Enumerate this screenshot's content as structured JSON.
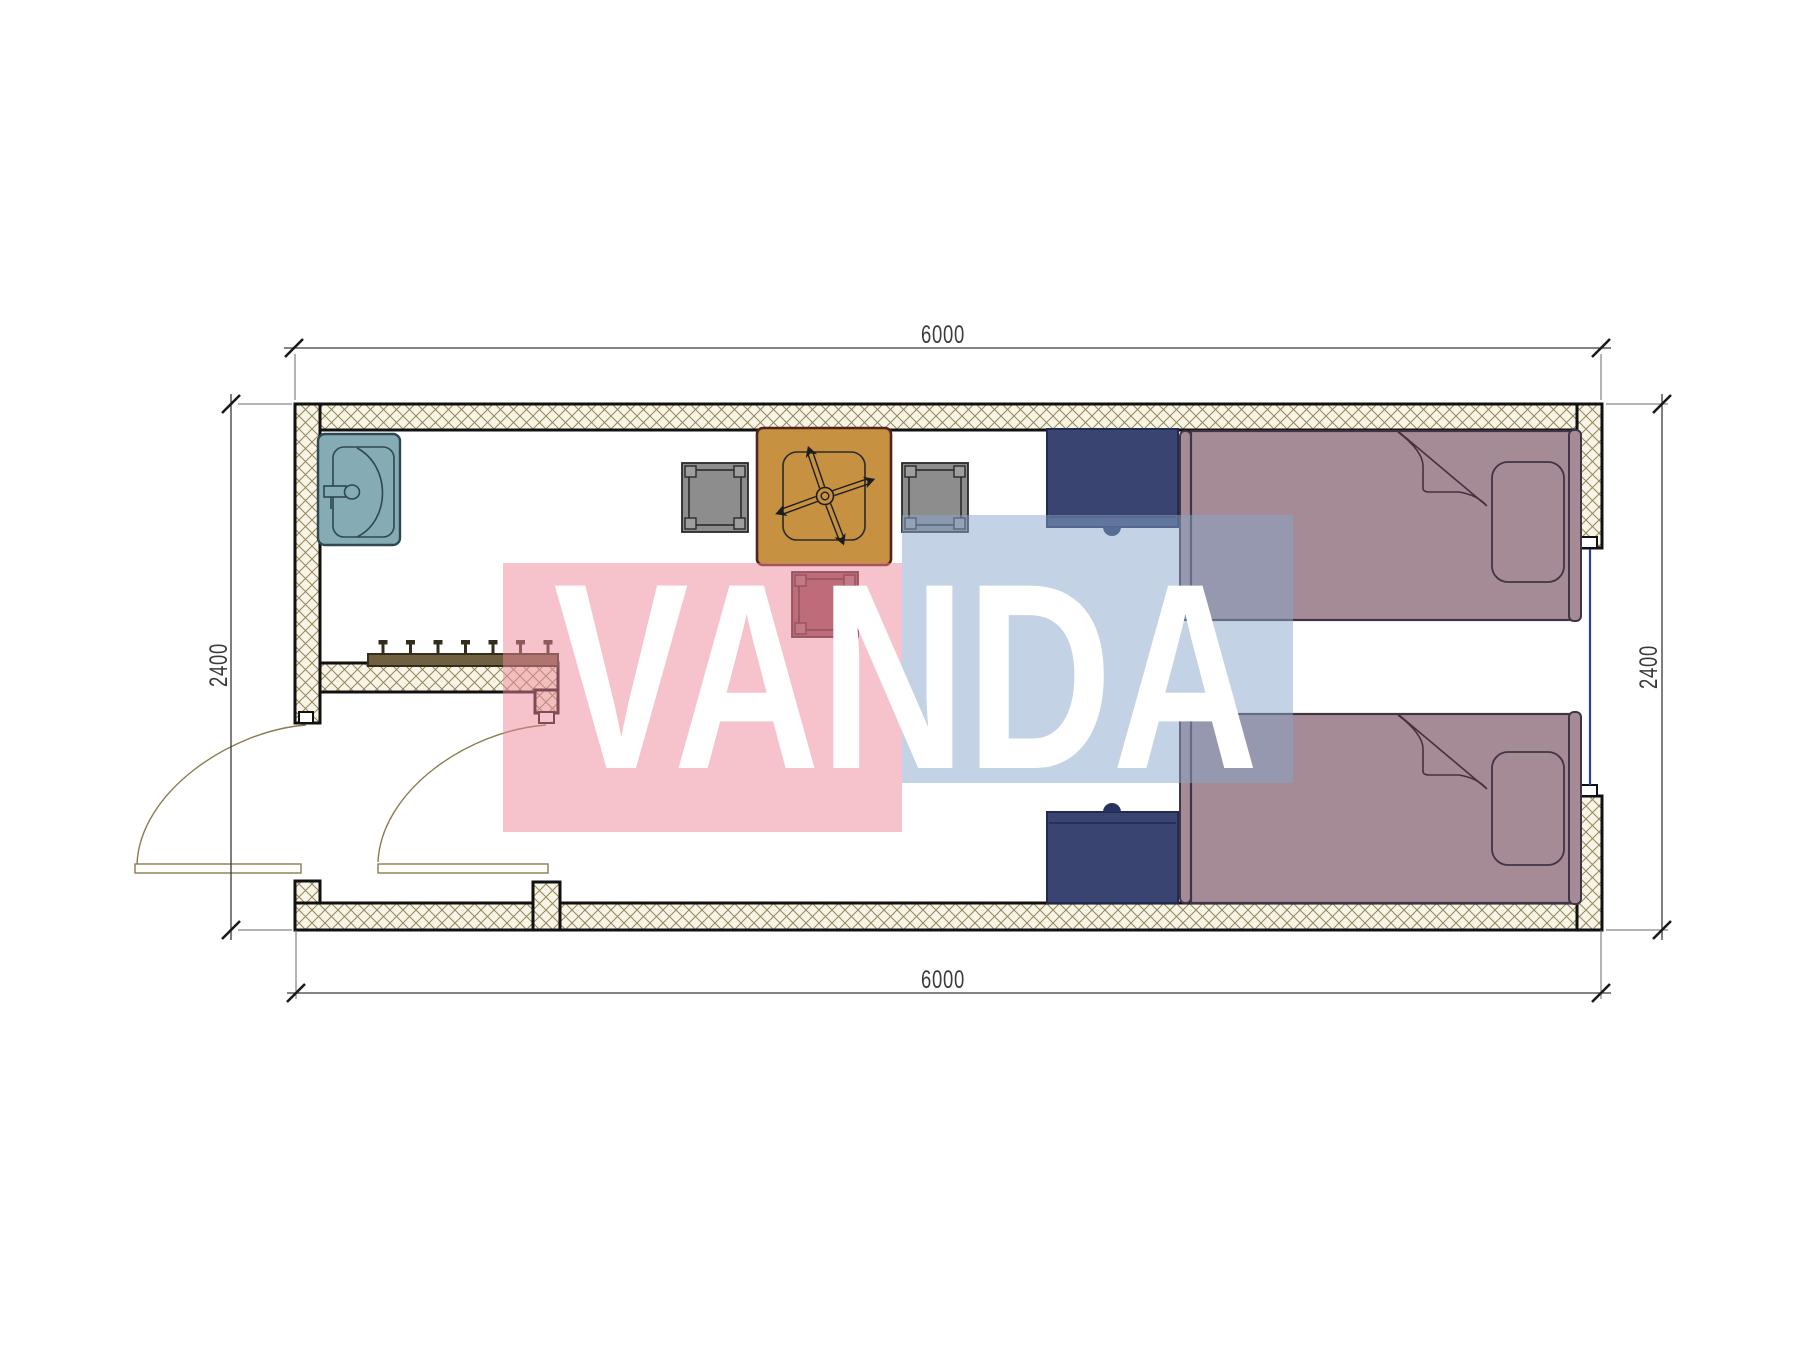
{
  "document": {
    "type": "architectural-floor-plan",
    "subject": "container cabin twin-bed room plan"
  },
  "dimensions": {
    "top_width": "6000",
    "bottom_width": "6000",
    "left_height": "2400",
    "right_height": "2400"
  },
  "watermark": {
    "text": "VANDA",
    "pink_color": "#ed8799",
    "blue_color": "#87a5c9",
    "text_color": "#ffffff"
  },
  "plan": {
    "wall_fill": "#f8f4e6",
    "wall_hatch_line": "#94865a",
    "wall_outline": "#111111",
    "door_line_color": "#8a7a4e",
    "window_color": "#2f3f96",
    "dimension_line_color": "#3a3a3a"
  },
  "elements": {
    "sink": {
      "color": "#85abb4"
    },
    "coat_rack": {
      "color": "#6f6140",
      "hooks": 7
    },
    "dining_table": {
      "color": "#c69140",
      "symbol": "ceiling-fan"
    },
    "stool_left": {
      "color": "#8d8d8d"
    },
    "stool_right": {
      "color": "#8d8d8d"
    },
    "stool_bottom": {
      "color": "#8e4f5b"
    },
    "nightstand_top": {
      "color": "#3a4470"
    },
    "nightstand_bottom": {
      "color": "#3a4470"
    },
    "bed_top": {
      "color": "#a58b96"
    },
    "bed_bottom": {
      "color": "#a58b96"
    },
    "doors": 2,
    "windows": 1
  }
}
